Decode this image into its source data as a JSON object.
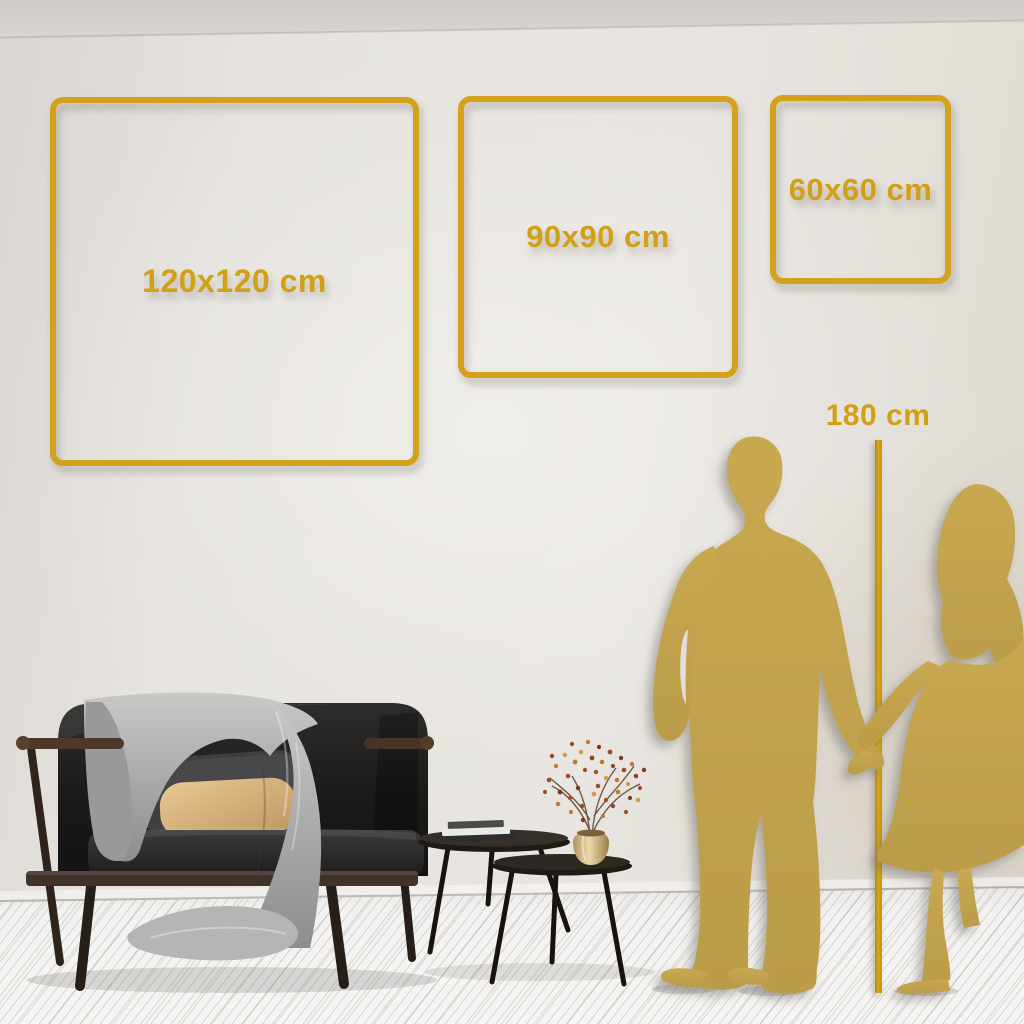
{
  "title": "Wall art square size guide room mockup",
  "size_frames": [
    {
      "id": "120",
      "label": "120x120 cm",
      "width_cm": 120,
      "height_cm": 120
    },
    {
      "id": "90",
      "label": "90x90 cm",
      "width_cm": 90,
      "height_cm": 90
    },
    {
      "id": "60",
      "label": "60x60 cm",
      "width_cm": 60,
      "height_cm": 60
    }
  ],
  "height_marker": {
    "label": "180 cm",
    "height_cm": 180
  },
  "colors": {
    "accent_gold": "#D4A11C",
    "gold_text": "#D2A014",
    "marker_line_gold": "#CC9A10",
    "silhouette_gold": "#C2A24E",
    "wall": "#E3E0DB",
    "floor": "#F3F2F0",
    "sofa_dark": "#1C1B1A",
    "pillow_beige": "#D8B57E",
    "blanket_gray": "#A9A9A8",
    "vase_brass": "#C9AE77"
  },
  "objects": {
    "couple": "man and woman silhouettes holding hands",
    "sofa": "dark velvet high-back sofa with wooden frame, gray throw blanket, dark gray and beige pillows",
    "tables": "two nesting round coffee tables with books and brass vase",
    "plant": "dried branch arrangement with rust-orange berries"
  }
}
